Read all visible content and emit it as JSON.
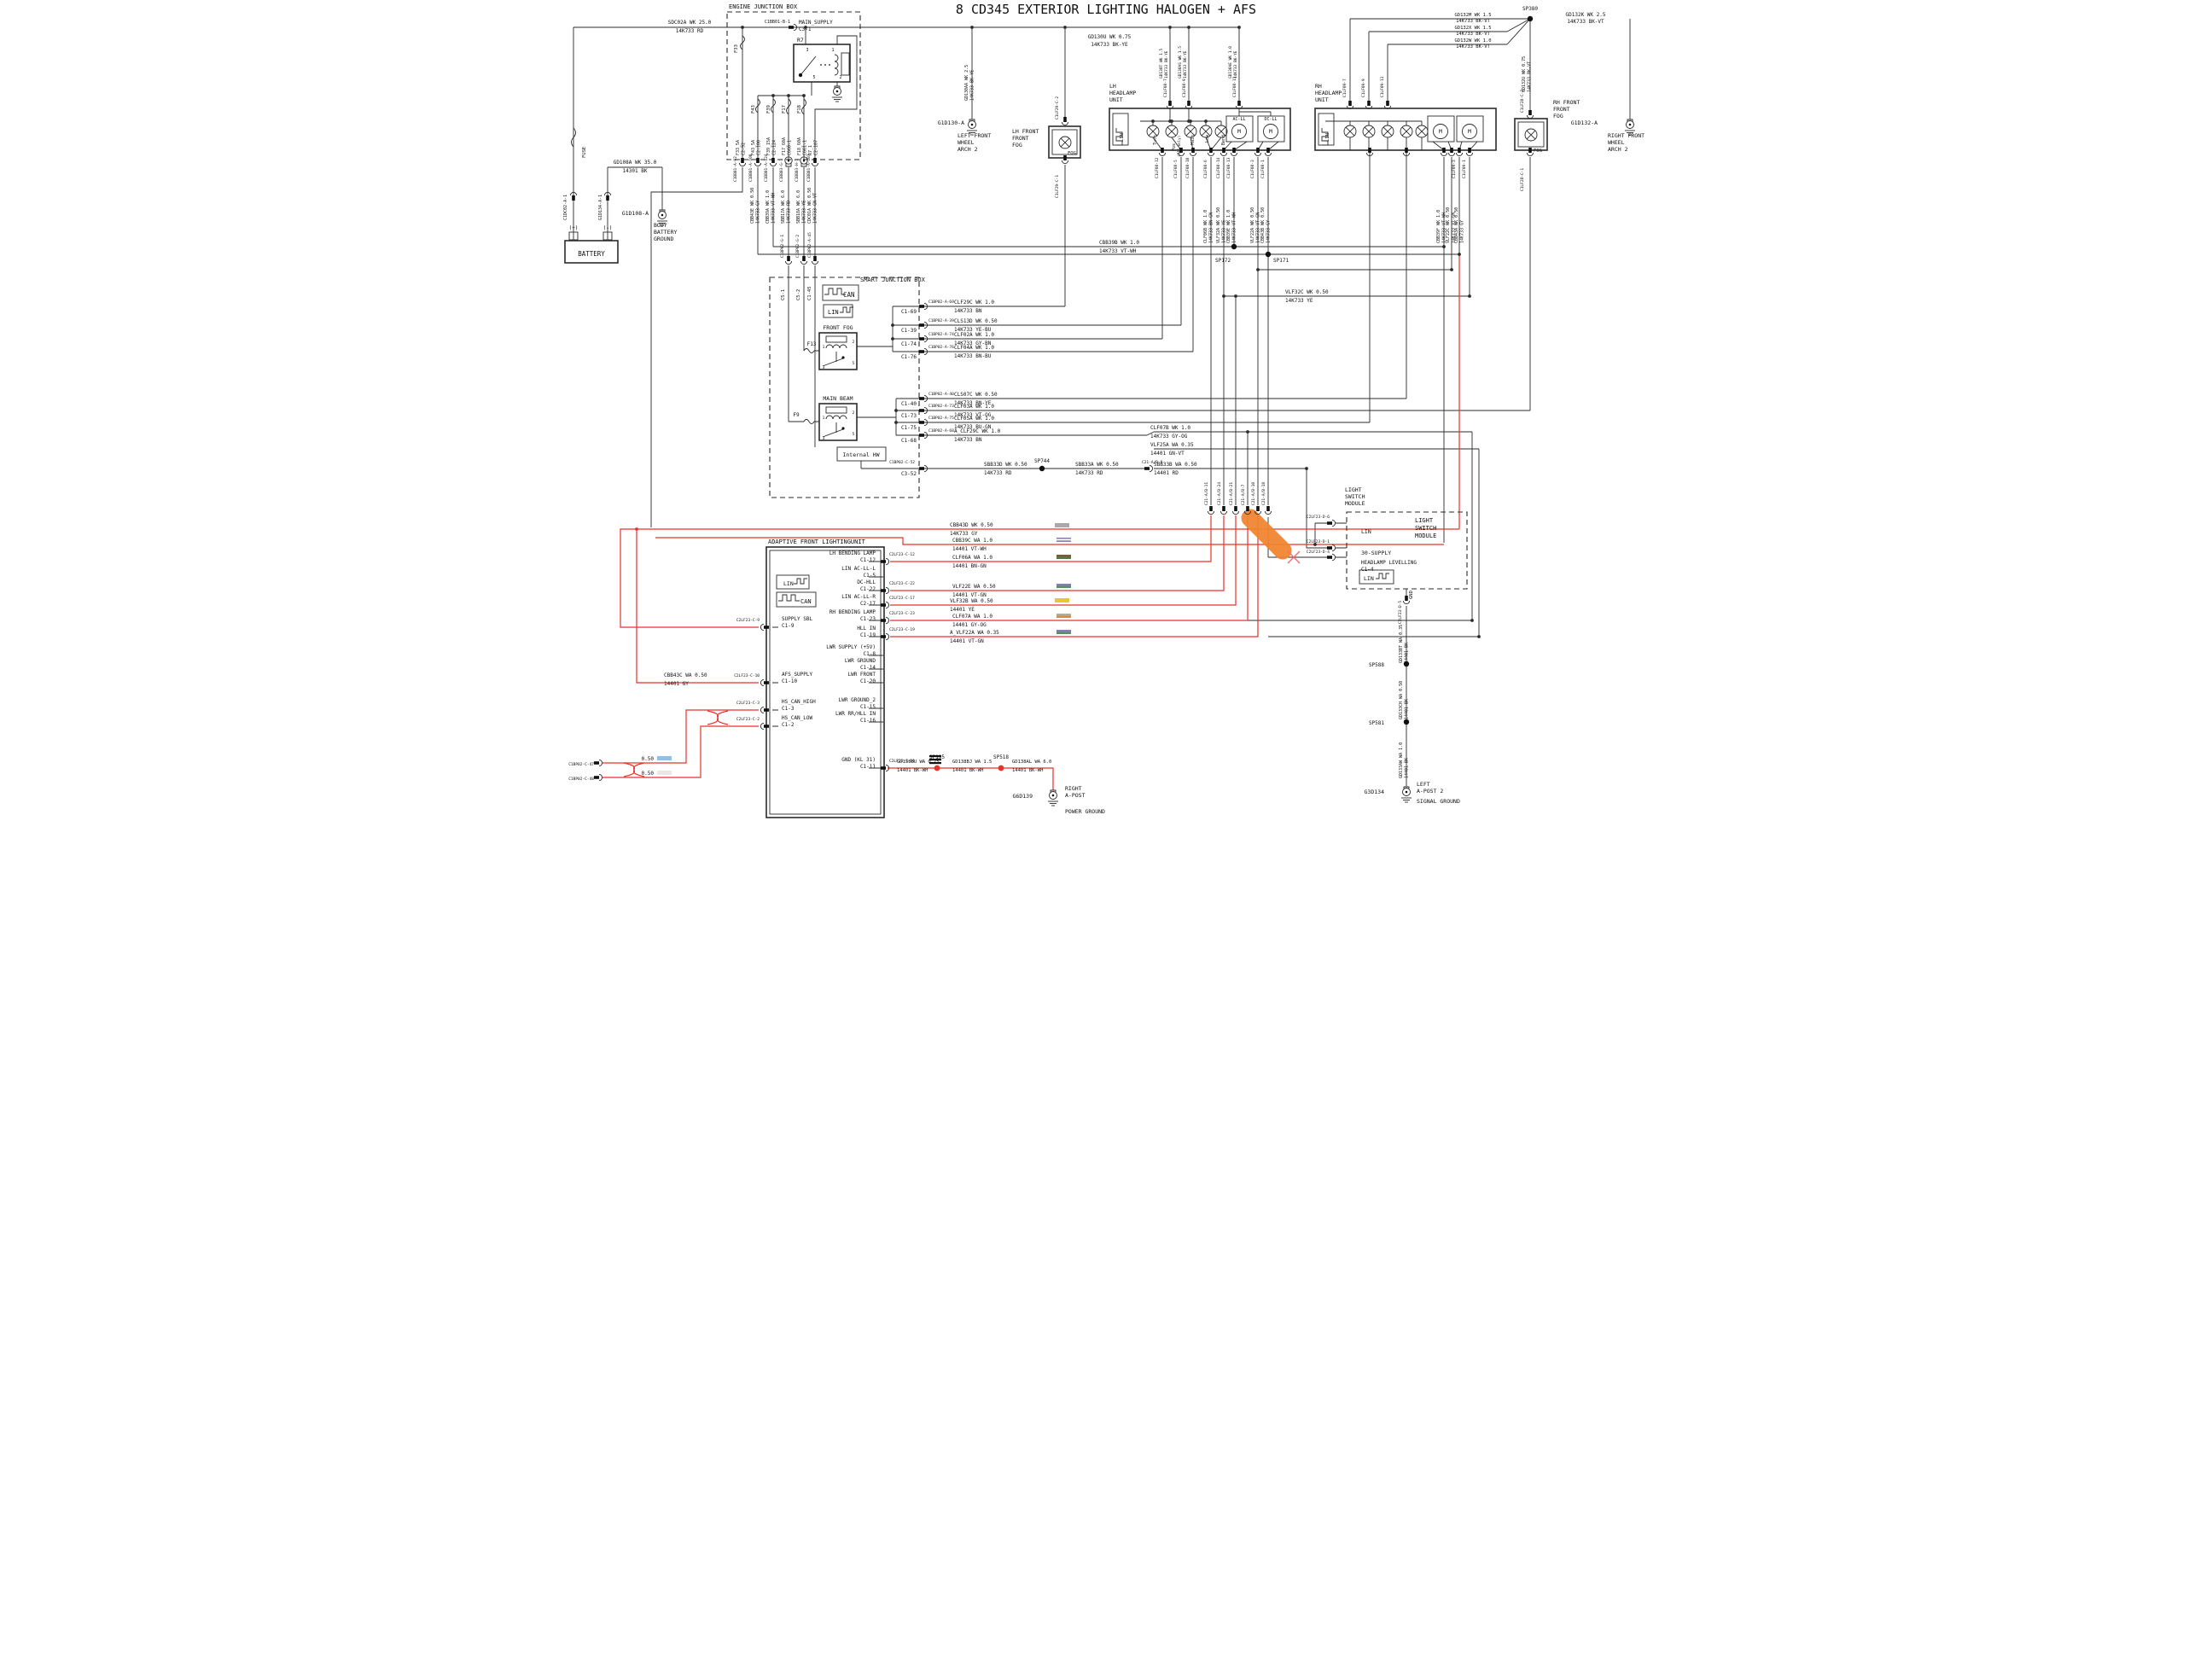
{
  "title": "8 CD345  EXTERIOR LIGHTING  HALOGEN + AFS",
  "colors": {
    "highlight_wire": "#e8332a",
    "marker": "#f0842f"
  },
  "labels": {
    "title": "8 CD345  EXTERIOR LIGHTING  HALOGEN + AFS",
    "ejb": "ENGINE JUNCTION BOX",
    "main_supply": "MAIN_SUPPLY\nC3-1",
    "r7": "R7",
    "p1": "1",
    "p2": "2",
    "p3": "3",
    "p5": "5",
    "f33": "F33",
    "f43": "F43",
    "f39": "F39",
    "f17": "F17",
    "f18": "F18",
    "f13": "F13",
    "f9": "F9",
    "f33r": "F33_5A\nC2-92",
    "f43r": "F43_5A\nC2-100",
    "f39r": "F39_15A\nC2-124",
    "f17r": "F17_60A\nC660-1",
    "f18r": "F18_60A\nC661-1",
    "r7r": "R7_1\nC2-107",
    "cb_b1": "C1BB01-B-1",
    "cb_a92": "C1BB01-A-92",
    "cb_a100": "C1BB01-A-100",
    "cb_a124": "C1BB01-A-124",
    "cb_g1": "C1BB03-G-1",
    "cb_h1": "C1BB03-H-1",
    "cb_a107": "C1BB01-A-107",
    "w_sdc02a": "SDC02A  WK  25.0\n14K733  RD",
    "w_gd108a": "GD108A  WK  35.0\n14301  BK",
    "battery": "BATTERY",
    "plus": "(+)",
    "minus": "(-)",
    "fusev": "FUSE",
    "c1dc02": "C1DC02-A-1",
    "g1d134": "G1D134-A-1",
    "g1d108": "G1D108-A",
    "body_gnd": "BODY\nBATTERY\nGROUND",
    "w_cbb43e": "CBB43E  WK  0.50\n14K733  GY",
    "w_cbb39a": "CBB39A  WK  1.0\n14K733  VT-WH",
    "w_sbb17a": "SBB17A  WK  6.0\n14K733  RD",
    "w_sbb18a": "SBB18A  WK  6.0\n14K733  YE",
    "w_cdc01a": "CDC01A  WK  0.50\n14K733  GN-VT",
    "cp_g1": "C1BP02-G-1",
    "cp_g2": "C1BP02-G-2",
    "cp_a45": "C1BP02-A-45",
    "c5_1": "C5-1",
    "c5_2": "C5-2",
    "c1_45": "C1-45",
    "sjb": "SMART JUNCTION BOX",
    "can": "CAN",
    "lin": "LIN",
    "front_fog": "FRONT FOG",
    "main_beam": "MAIN BEAM",
    "internal_hw": "Internal HW",
    "c1_69": "C1-69",
    "c1_39": "C1-39",
    "c1_74": "C1-74",
    "c1_76": "C1-76",
    "c1_40": "C1-40",
    "c1_73": "C1-73",
    "c1_75": "C1-75",
    "c1_68": "C1-68",
    "c3_52": "C3-52",
    "cp_a69": "C1BP02-A-69",
    "cp_a39": "C1BP02-A-39",
    "cp_a74": "C1BP02-A-74",
    "cp_a76": "C1BP02-A-76",
    "cp_a40": "C1BP02-A-40",
    "cp_a73": "C1BP02-A-73",
    "cp_a75": "C1BP02-A-75",
    "cp_a68": "C1BP02-A-68",
    "cp_c52": "C1BP02-C-52",
    "w_clf29c": "CLF29C  WK  1.0\n14K733  BN",
    "w_cls13d": "CLS13D  WK  0.50\n14K733  YE-BU",
    "w_clf02a": "CLF02A  WK  1.0\n14K733  GY-BN",
    "w_clf04a": "CLF04A  WK  1.0\n14K733  BN-BU",
    "w_cls07c": "CLS07C  WK  0.50\n14K733  BN-YE",
    "w_clf03a": "CLF03A  WK  1.0\n14K733  VT-OG",
    "w_clf05a": "CLF05A  WK  1.0\n14K733  BU-GN",
    "w_aclf29c": "A_CLF29C WK  1.0\n14K733  BN",
    "w_cbb39b": "CBB39B  WK  1.0\n14K733  VT-WH",
    "w_vlf32c": "VLF32C  WK  0.50\n14K733  YE",
    "sp172": "SP172",
    "sp171": "SP171",
    "sp744": "SP744",
    "sp380": "SP380",
    "sp195": "SP195",
    "sp518": "SP518",
    "sp588": "SP588",
    "sp581": "SP581",
    "w_gd130aa": "GD130AA  WK  2.5\n14K733  BK-YE",
    "w_gd130u": "GD130U  WK  0.75\n14K733  BK-YE",
    "w_gd130t": "GD130T  WK  1.5\n14K733  BK-YE",
    "w_gd130as": "GD130AS  WK  1.5\n14K733  BK-YE",
    "w_gd130ae": "GD130AE  WK  1.0\n14K733  BK-YE",
    "g1d130": "G1D130-A",
    "lf_arch": "LEFT FRONT\nWHEEL\nARCH 2",
    "lh_fog": "LH FRONT\nFRONT\nFOG",
    "fog": "FOG",
    "lh_unit": "LH\nHEADLAMP\nUNIT",
    "rh_unit": "RH\nHEADLAMP\nUNIT",
    "turn": "Turn",
    "pos": "Pos",
    "pos345": "(345 only)",
    "main": "Main",
    "low": "Low",
    "bend": "Bend",
    "acll": "AC-LL",
    "dcll": "DC-LL",
    "m": "M",
    "cl08_7": "C1LF08-7",
    "cl08_9": "C1LF08-9",
    "cl08_11": "C1LF08-11",
    "cl08_12": "C1LF08-12",
    "cl08_5": "C1LF08-5",
    "cl08_10": "C1LF08-10",
    "cl08_6": "C1LF08-6",
    "cl08_14": "C1LF08-14",
    "cl08_13": "C1LF08-13",
    "cl08_3": "C1LF08-3",
    "cl08_1": "C1LF08-1",
    "cl29_2": "C1LF29-C-2",
    "cl29_1": "C1LF29-C-1",
    "cl28_2": "C1LF28-C-2",
    "cl28_1": "C1LF28-C-1",
    "cl09_7": "C1LF09-7",
    "cl09_9": "C1LF09-9",
    "cl09_11": "C1LF09-11",
    "cl09_3": "C1LF09-3",
    "cl09_1": "C1LF09-1",
    "w_clf06b": "CLF06B  WK  1.0\n14K733  BN-GN",
    "w_vlf32a": "VLF32A  WK  0.50\n14K733  YE",
    "w_cbb39e": "CBB39E  WK  1.0\n14K733  VT-WH",
    "w_vlf22a": "VLF22A  WK  0.50\n14K733  VT-GN",
    "w_cbb43b": "CBB43B  WK  0.50\n14K733  GY",
    "w_cbb39f": "CBB39F  WK  1.0\n14K733  VT-WH",
    "w_vlf22c": "VLF22C  WK  0.50\n14K733  VT-GN",
    "w_cbb43a": "CBB43A  WK  0.50\n14K733  GY",
    "w_gd132m": "GD132M  WK  1.5\n14K733  BK-VT",
    "w_gd132x": "GD132X  WK  1.5\n14K733  BK-VT",
    "w_gd132w": "GD132W  WK  1.0\n14K733  BK-VT",
    "w_gd132k": "GD132K  WK  2.5\n14K733  BK-VT",
    "w_gd132u": "GD132U  WK  0.75\n14K733  BK-VT",
    "rh_fog": "RH FRONT\nFRONT\nFOG",
    "g1d132": "G1D132-A",
    "rf_arch": "RIGHT FRONT\nWHEEL\nARCH 2",
    "w_clf07b": "CLF07B  WK  1.0\n14K733  GY-OG",
    "w_vlf25a": "VLF25A  WA  0.35\n14401  GN-VT",
    "w_sbb33d": "SBB33D  WK  0.50\n14K733  RD",
    "w_sbb33a": "SBB33A  WK  0.50\n14K733  RD",
    "w_sbb33b": "SBB33B  WA  0.50\n14401  RD",
    "c21_9": "C21-A/B-9",
    "c21_11": "C21-A/B-11",
    "c21_24": "C21-A/B-24",
    "c21_21": "C21-A/B-21",
    "c21_7": "C21-A/B-7",
    "c21_10": "C21-A/B-10",
    "c21_18": "C21-A/B-18",
    "lsm": "LIGHT\nSWITCH\nMODULE",
    "supply30": "30-SUPPLY",
    "hl_lev": "HEADLAMP LEVELLING\nC1-4",
    "gnd": "GND",
    "cd6": "C2LF23-D-6",
    "cd1": "C2LF23-D-1",
    "cd4": "C2LF23-D-4",
    "cd5": "C2LF23-D-5",
    "w_gd133bt": "GD133BT  WA  0.35\n14401  BK",
    "w_gd133ch": "GD133CH  WA  0.50\n14401  BK",
    "w_gd133aw": "GD133AW  WA  1.0\n14401  BK",
    "g3d134": "G3D134",
    "lapost": "LEFT\nA-POST 2",
    "sig_gnd": "SIGNAL GROUND",
    "afl": "ADAPTIVE FRONT LIGHTINGUNIT",
    "p_lhbend": "LH BENDING LAMP\nC1-12",
    "p_linl": "LIN AC-LL-L\nC1-5",
    "p_dchll": "DC-HLL\nC1-22",
    "p_linr": "LIN AC-LL-R\nC2-17",
    "p_rhbend": "RH BENDING LAMP\nC1-23",
    "p_hll": "HLL IN\nC1-19",
    "p_lwrs": "LWR SUPPLY (+5V)\nC1-8",
    "p_lwrg": "LWR GROUND\nC1-14",
    "p_lwrf": "LWR FRONT\nC1-20",
    "p_lwrg2": "LWR GROUND_2\nC1-15",
    "p_lwrrr": "LWR RR/HLL IN\nC1-16",
    "p_gnd": "GND (KL 31)\nC1-11",
    "p_sbl": "SUPPLY SBL\nC1-9",
    "p_afs": "AFS_SUPPLY\nC1-10",
    "p_canh": "HS_CAN_HIGH\nC1-3",
    "p_canl": "HS_CAN_LOW\nC1-2",
    "cc12": "C2LF23-C-12",
    "cc22": "C2LF23-C-22",
    "cc17": "C2LF23-C-17",
    "cc23": "C2LF23-C-23",
    "cc19": "C2LF23-C-19",
    "cc9": "C2LF23-C-9",
    "cc10": "C2LF23-C-10",
    "cc3": "C2LF23-C-3",
    "cc2": "C2LF23-C-2",
    "cc11": "C2LF23-C-11",
    "w_cbb43d": "CBB43D  WK  0.50\n14K733  GY",
    "w_cbb39c": "CBB39C  WA  1.0\n14401  VT-WH",
    "w_clf06a": "CLF06A  WA  1.0\n14401  BN-GN",
    "w_vlf22e": "VLF22E  WA  0.50\n14401  VT-GN",
    "w_vlf32b": "VLF32B  WA  0.50\n14401  YE",
    "w_clf07a": "CLF07A  WA  1.0\n14401  GY-OG",
    "w_avlf22a": "A_VLF22A WA  0.35\n14401  VT-GN",
    "w_cbb43c": "CBB43C  WA  0.50\n14401  GY",
    "half50": "0.50",
    "cp_c47": "C1BP02-C-47",
    "cp_c48": "C1BP02-C-48",
    "w_gd138bu": "GD138BU WA 0.75\n14401  BK-WH",
    "w_gd138bj": "GD138BJ WA 1.5\n14401  BK-WH",
    "w_gd138al": "GD138AL WA 6.0\n14401  BK-WH",
    "g6d139": "G6D139",
    "r_apost": "RIGHT\nA-POST",
    "pwr_gnd": "POWER GROUND"
  },
  "swatches": {
    "cbb43d": [
      "#a9a9a9"
    ],
    "cbb39c": [
      "#8a7ab8",
      "#ffffff",
      "#8a7ab8"
    ],
    "clf06a": [
      "#7a5a38",
      "#4e7a40"
    ],
    "vlf22e": [
      "#8a7ab8",
      "#56925c"
    ],
    "vlf32b": [
      "#e9c53d"
    ],
    "clf07a": [
      "#b4ab9d",
      "#d28d4e"
    ],
    "avlf22a": [
      "#8a7ab8",
      "#56925c"
    ],
    "tp1": [
      "#8fc0e8"
    ],
    "tp2": [
      "#e8e8e4"
    ]
  }
}
